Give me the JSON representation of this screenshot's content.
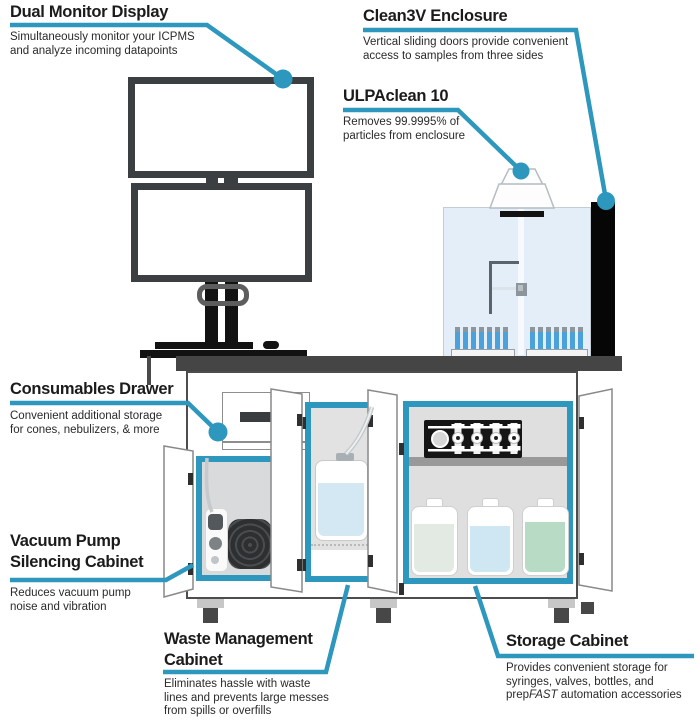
{
  "colors": {
    "accent": "#2E97BD",
    "monitor_frame": "#3C3F41",
    "bench": "#454545",
    "enclosure_fill": "#E4EEF9",
    "vial_blue": "#4BA2DA",
    "bottle_liquids": [
      "#E2EAE3",
      "#CFE6F3",
      "#B7DBC5"
    ]
  },
  "callouts": {
    "dual_monitor": {
      "title": "Dual Monitor Display",
      "line1": "Simultaneously monitor your ICPMS",
      "line2": "and analyze incoming datapoints"
    },
    "clean3v": {
      "title": "Clean3V Enclosure",
      "line1": "Vertical sliding doors provide convenient",
      "line2": "access to samples from three sides"
    },
    "ulpaclean": {
      "title": "ULPAclean 10",
      "line1": "Removes 99.9995% of",
      "line2": "particles from enclosure"
    },
    "consumables": {
      "title": "Consumables Drawer",
      "line1": "Convenient additional storage",
      "line2": "for cones, nebulizers, & more"
    },
    "vacuum_pump": {
      "title_line1": "Vacuum Pump",
      "title_line2": "Silencing Cabinet",
      "line1": "Reduces vacuum pump",
      "line2": "noise and vibration"
    },
    "waste": {
      "title_line1": "Waste Management",
      "title_line2": "Cabinet",
      "line1": "Eliminates hassle with waste",
      "line2": "lines and prevents large messes",
      "line3": "from spills or overfills"
    },
    "storage": {
      "title": "Storage Cabinet",
      "line1": "Provides convenient storage for",
      "line2": "syringes, valves, bottles, and",
      "line3_prefix": "prep",
      "line3_italic": "FAST",
      "line3_suffix": " automation accessories"
    }
  }
}
